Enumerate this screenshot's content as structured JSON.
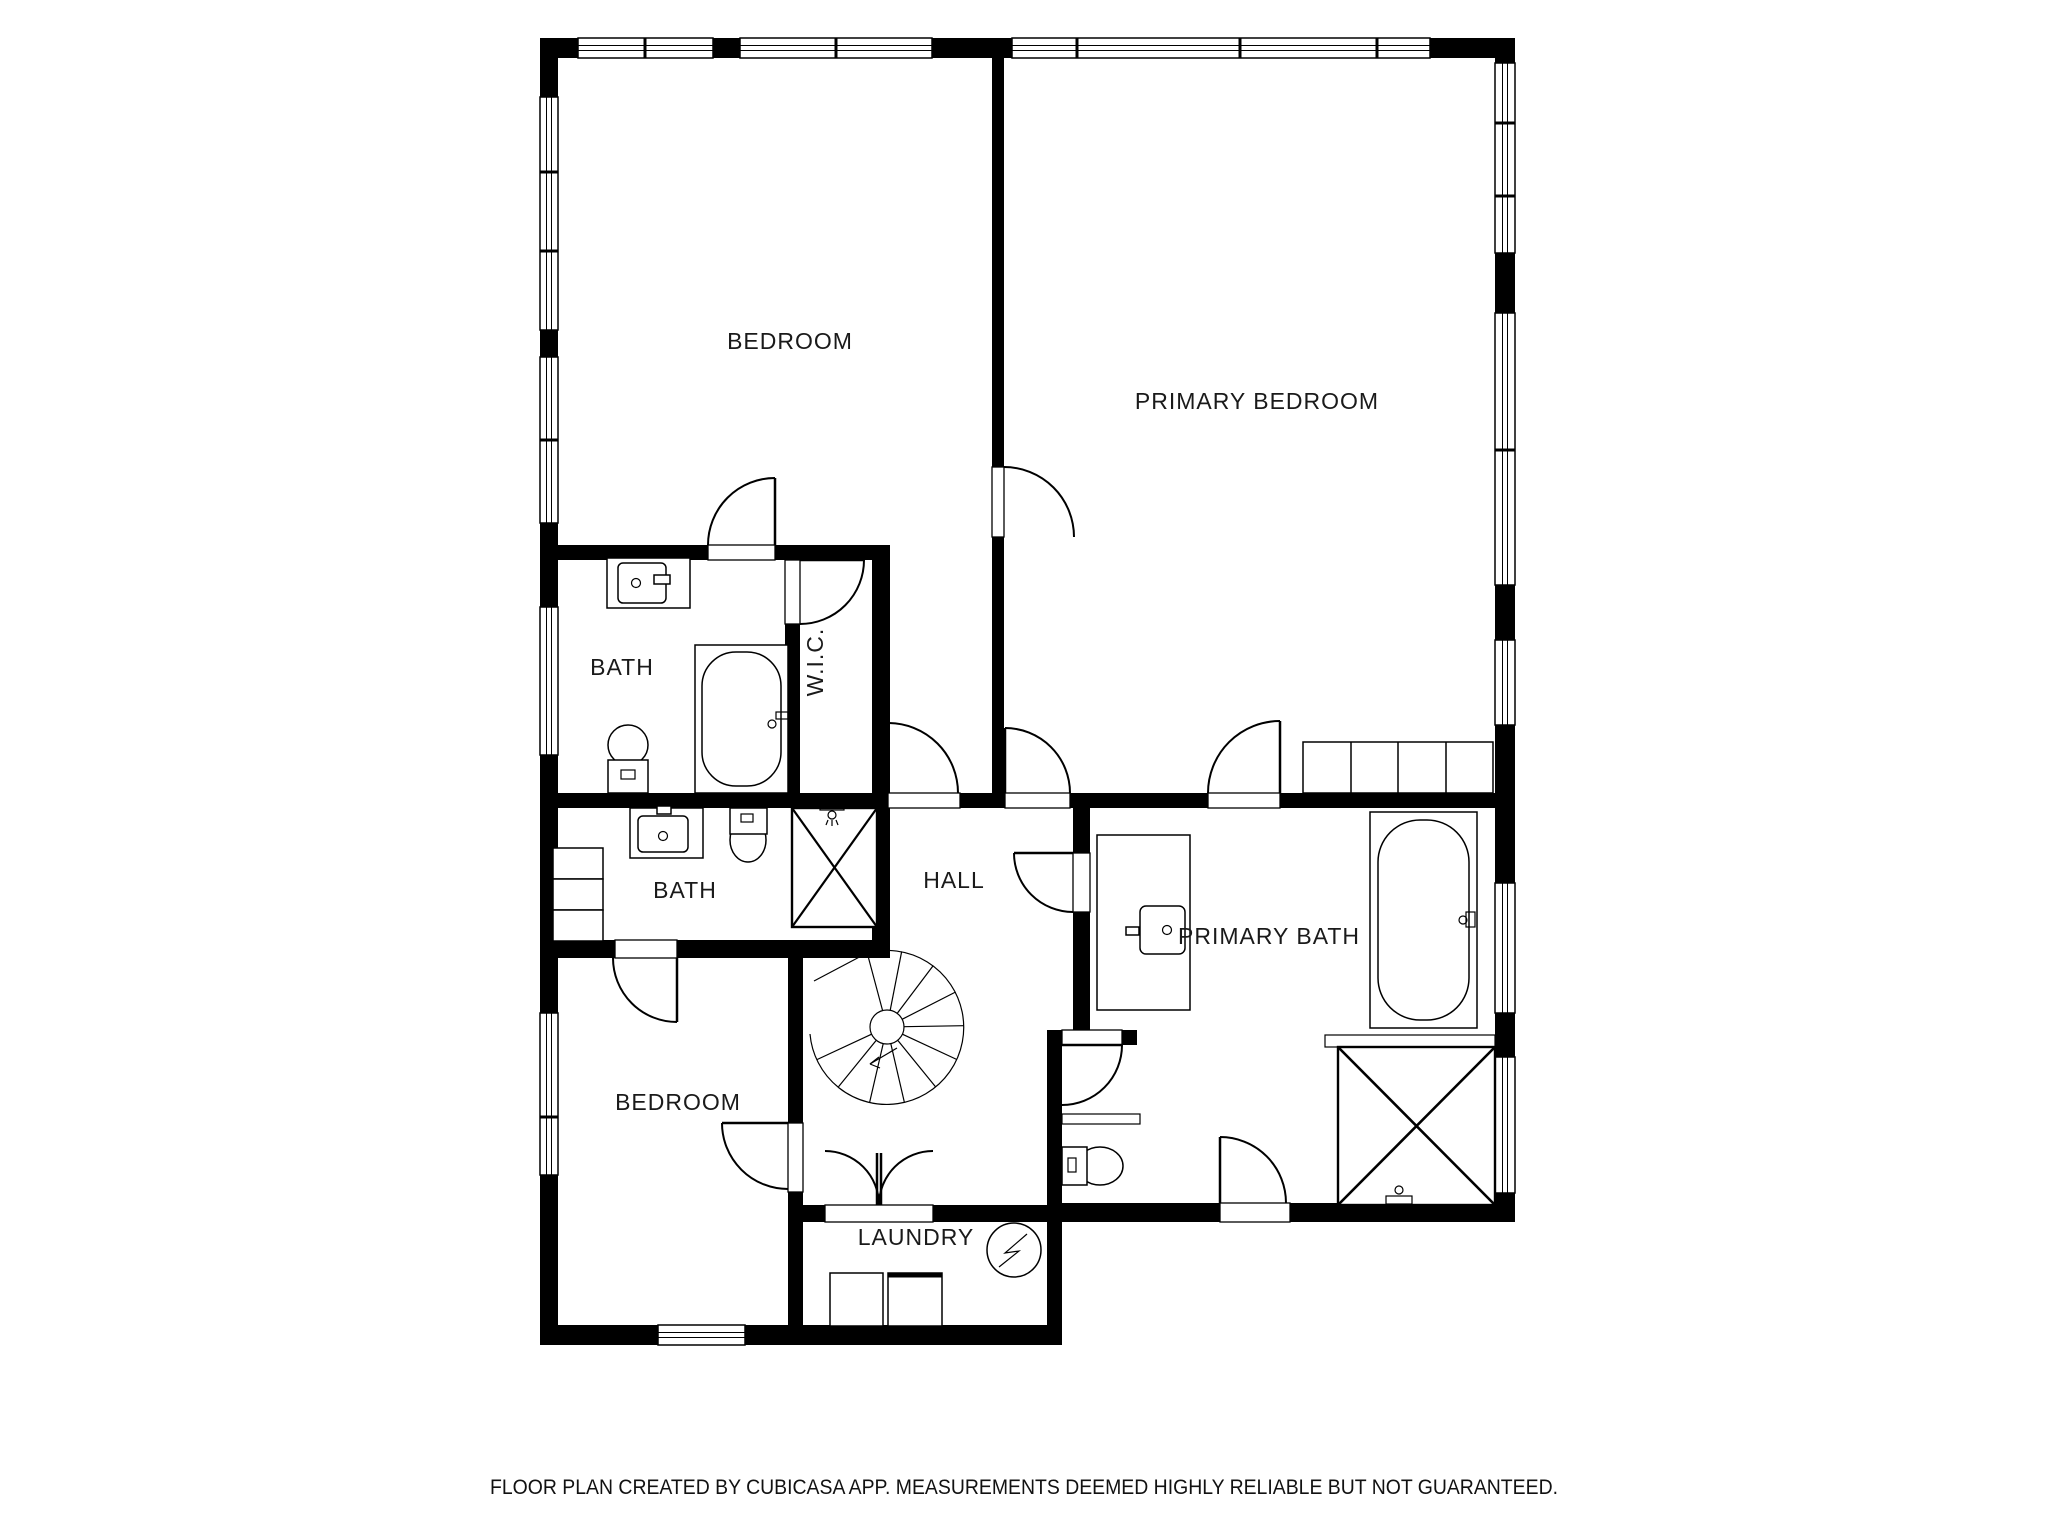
{
  "page": {
    "background": "#ffffff",
    "kind": "floor-plan"
  },
  "colors": {
    "wall": "#000000",
    "floor": "#ffffff",
    "label": "#1a1a1a"
  },
  "rooms": {
    "bedroom_top": {
      "label": "BEDROOM",
      "fixtures": []
    },
    "primary_bedroom": {
      "label": "PRIMARY BEDROOM",
      "fixtures": [
        "wardrobe"
      ]
    },
    "bath_upper": {
      "label": "BATH",
      "fixtures": [
        "sink-vanity",
        "bathtub",
        "toilet"
      ]
    },
    "wic": {
      "label": "W.I.C.",
      "fixtures": []
    },
    "bath_lower": {
      "label": "BATH",
      "fixtures": [
        "sink-vanity",
        "toilet",
        "shower",
        "shelves"
      ]
    },
    "hall": {
      "label": "HALL",
      "fixtures": [
        "spiral-staircase"
      ]
    },
    "primary_bath": {
      "label": "PRIMARY BATH",
      "fixtures": [
        "sink-vanity",
        "bathtub",
        "shower",
        "toilet",
        "shelf",
        "counter"
      ]
    },
    "bedroom_bottom": {
      "label": "BEDROOM",
      "fixtures": []
    },
    "laundry": {
      "label": "LAUNDRY",
      "fixtures": [
        "washer",
        "dryer",
        "electrical-panel"
      ]
    }
  },
  "icons": {
    "bathtub": "bathtub-icon",
    "toilet": "toilet-icon",
    "sink": "sink-vanity-icon",
    "shower": "shower-icon",
    "spiral_staircase": "spiral-staircase-icon",
    "washer": "washer-icon",
    "dryer": "dryer-icon",
    "electrical_panel": "electrical-panel-icon",
    "wardrobe": "wardrobe-icon",
    "window": "window-icon",
    "door": "door-icon"
  },
  "footer": {
    "disclaimer": "FLOOR PLAN CREATED BY CUBICASA APP. MEASUREMENTS DEEMED HIGHLY RELIABLE BUT NOT GUARANTEED."
  }
}
